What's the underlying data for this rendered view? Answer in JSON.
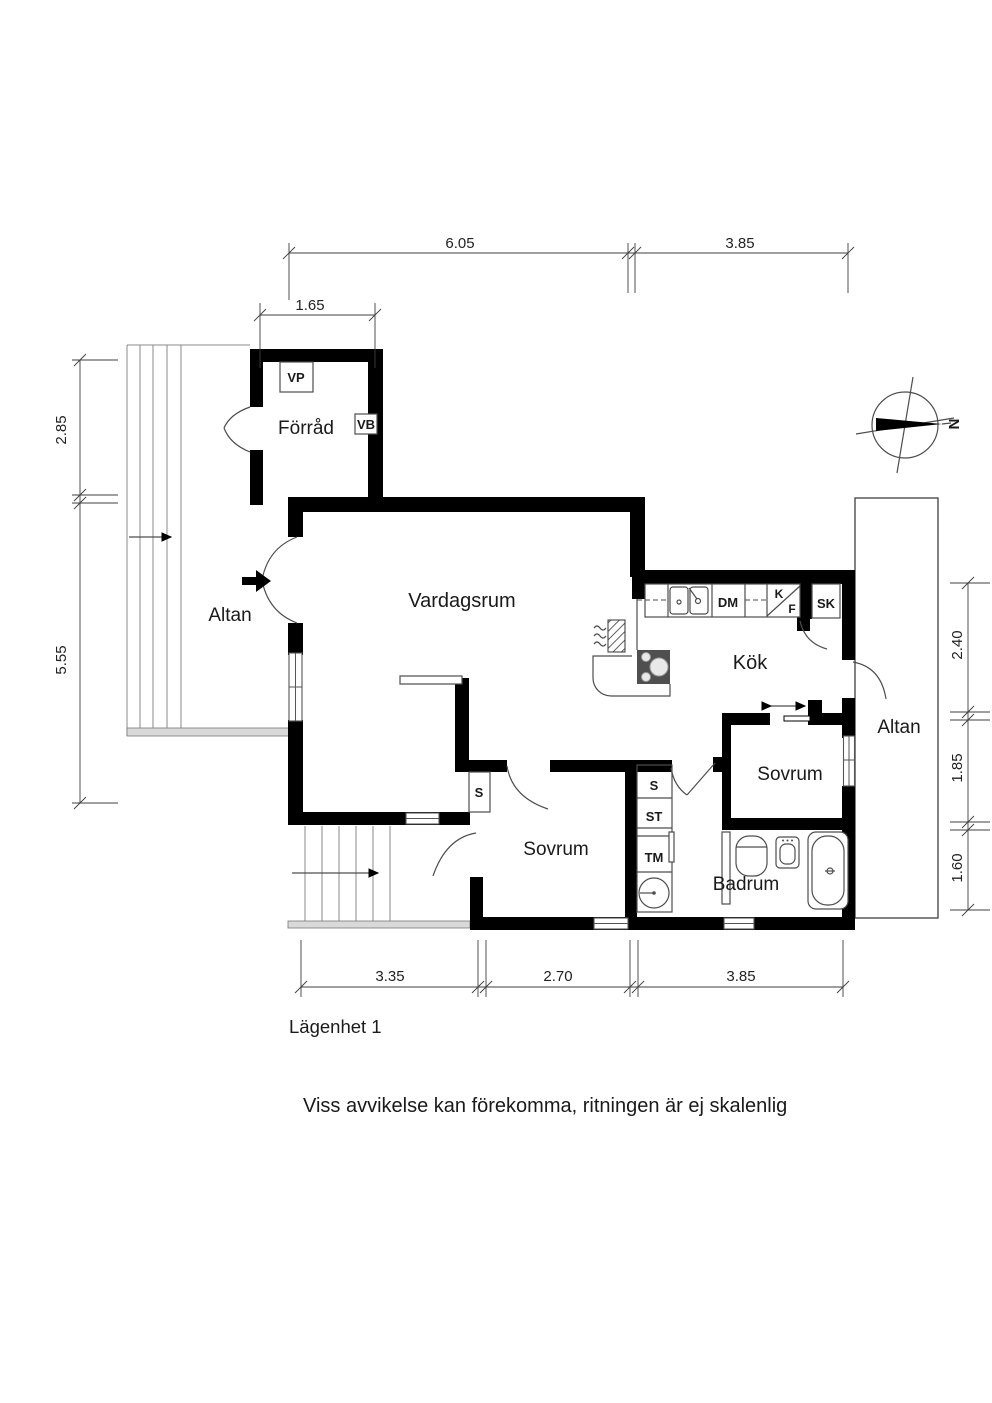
{
  "title": "Lägenhet 1",
  "disclaimer": "Viss avvikelse kan förekomma, ritningen är ej skalenlig",
  "compass": {
    "north": "N"
  },
  "rooms": {
    "forrad": "Förråd",
    "vardagsrum": "Vardagsrum",
    "altan_left": "Altan",
    "kok": "Kök",
    "sovrum_right": "Sovrum",
    "altan_right": "Altan",
    "sovrum_bottom": "Sovrum",
    "badrum": "Badrum"
  },
  "labels": {
    "vp": "VP",
    "vb": "VB",
    "dm": "DM",
    "k": "K",
    "f": "F",
    "sk": "SK",
    "s_hall": "S",
    "s_utility": "S",
    "st": "ST",
    "tm": "TM"
  },
  "dimensions": {
    "top_main": [
      "6.05",
      "3.85"
    ],
    "top_forrad": "1.65",
    "left": [
      "2.85",
      "5.55"
    ],
    "right": [
      "2.40",
      "1.85",
      "1.60"
    ],
    "bottom": [
      "3.35",
      "2.70",
      "3.85"
    ]
  },
  "colors": {
    "wall": "#000000",
    "thin_line": "#4d4d4d",
    "dim_line": "#3f3f3f",
    "stove_fill": "#4f4f4f",
    "deck_strip": "#d9d9d9",
    "background": "#ffffff",
    "text": "#1a1a1a"
  }
}
